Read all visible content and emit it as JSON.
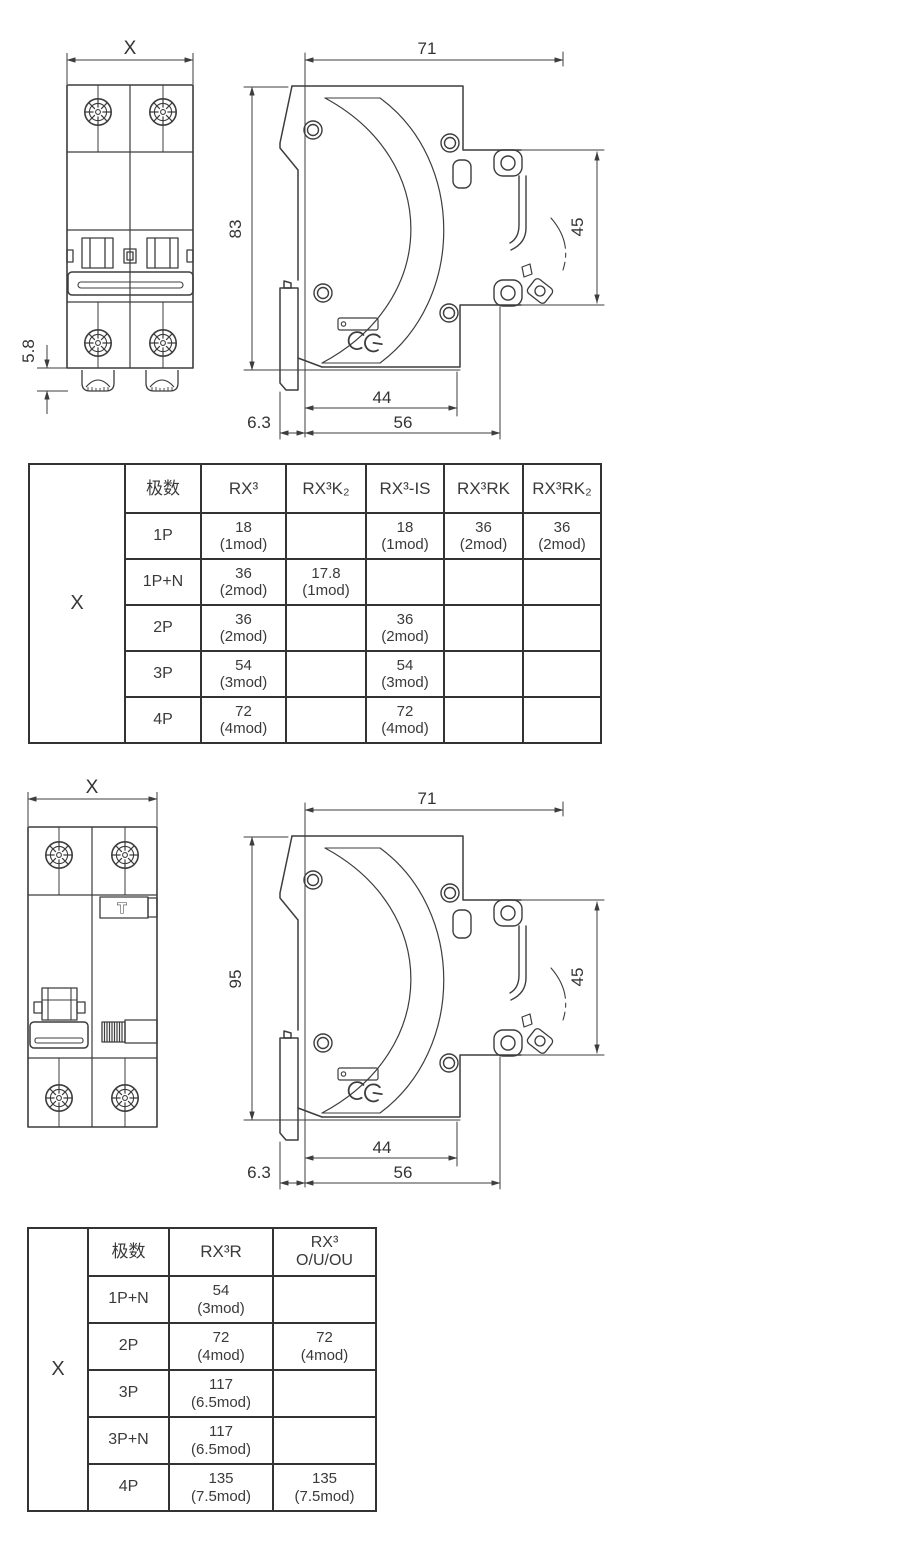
{
  "drawing_top": {
    "front_view": {
      "width_label": "X",
      "terminal_depth_label": "5.8"
    },
    "side_view": {
      "width_label": "71",
      "height_label": "83",
      "din_rail_label": "45",
      "body_depth_label": "44",
      "total_depth_label": "56",
      "clip_offset_label": "6.3"
    }
  },
  "table1": {
    "corner_label": "X",
    "headers": [
      "极数",
      "RX³",
      "RX³K₂",
      "RX³-IS",
      "RX³RK",
      "RX³RK₂"
    ],
    "rows": [
      {
        "pole": "1P",
        "cells": [
          "18\n(1mod)",
          "",
          "18\n(1mod)",
          "36\n(2mod)",
          "36\n(2mod)"
        ]
      },
      {
        "pole": "1P+N",
        "cells": [
          "36\n(2mod)",
          "17.8\n(1mod)",
          "",
          "",
          ""
        ]
      },
      {
        "pole": "2P",
        "cells": [
          "36\n(2mod)",
          "",
          "36\n(2mod)",
          "",
          ""
        ]
      },
      {
        "pole": "3P",
        "cells": [
          "54\n(3mod)",
          "",
          "54\n(3mod)",
          "",
          ""
        ]
      },
      {
        "pole": "4P",
        "cells": [
          "72\n(4mod)",
          "",
          "72\n(4mod)",
          "",
          ""
        ]
      }
    ]
  },
  "drawing_bottom": {
    "front_view": {
      "width_label": "X",
      "test_button_label": "T"
    },
    "side_view": {
      "width_label": "71",
      "height_label": "95",
      "din_rail_label": "45",
      "body_depth_label": "44",
      "total_depth_label": "56",
      "clip_offset_label": "6.3"
    }
  },
  "table2": {
    "corner_label": "X",
    "headers": [
      "极数",
      "RX³R",
      "RX³\nO/U/OU"
    ],
    "rows": [
      {
        "pole": "1P+N",
        "cells": [
          "54\n(3mod)",
          ""
        ]
      },
      {
        "pole": "2P",
        "cells": [
          "72\n(4mod)",
          "72\n(4mod)"
        ]
      },
      {
        "pole": "3P",
        "cells": [
          "117\n(6.5mod)",
          ""
        ]
      },
      {
        "pole": "3P+N",
        "cells": [
          "117\n(6.5mod)",
          ""
        ]
      },
      {
        "pole": "4P",
        "cells": [
          "135\n(7.5mod)",
          "135\n(7.5mod)"
        ]
      }
    ]
  },
  "colors": {
    "line": "#3d3d3d",
    "table_border": "#333333",
    "text": "#333333",
    "background": "#ffffff"
  }
}
